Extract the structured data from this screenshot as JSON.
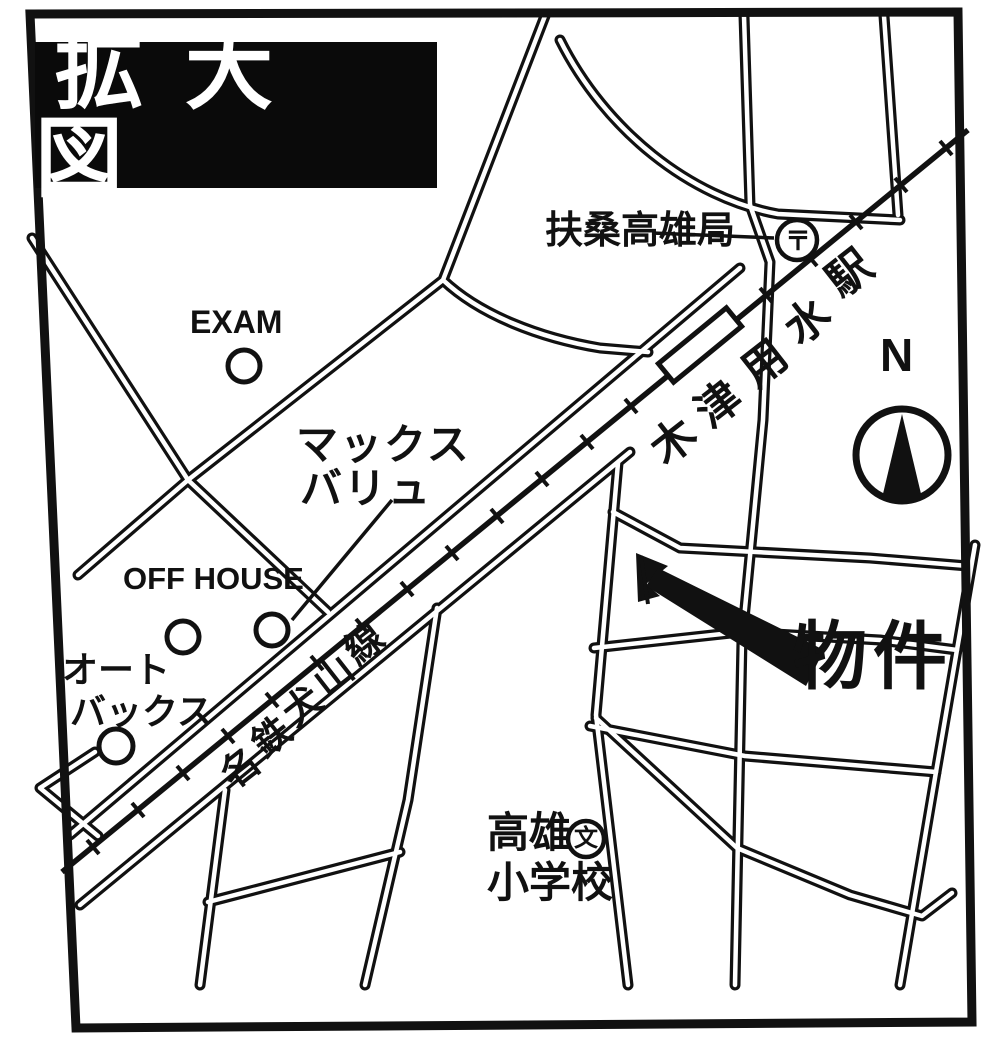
{
  "title": "拡大図",
  "compass": {
    "label": "N"
  },
  "station": {
    "name": "木津用水駅",
    "chars": [
      "木",
      "津",
      "用",
      "水",
      "駅"
    ]
  },
  "rail_line": {
    "name": "名鉄犬山線",
    "chars": [
      "名",
      "鉄",
      "犬",
      "山",
      "線"
    ]
  },
  "places": {
    "post_office": {
      "label": "扶桑高雄局",
      "symbol": "〒"
    },
    "exam": {
      "label": "EXAM"
    },
    "max_valu": {
      "line1": "マックス",
      "line2": "バリュ"
    },
    "off_house": {
      "label": "OFF HOUSE"
    },
    "autobacs": {
      "line1": "オート",
      "line2": "バックス"
    },
    "school": {
      "line1": "高雄",
      "line2": "小学校",
      "symbol": "文"
    },
    "property": {
      "label": "物件"
    }
  },
  "colors": {
    "ink": "#111111",
    "paper": "#ffffff"
  }
}
